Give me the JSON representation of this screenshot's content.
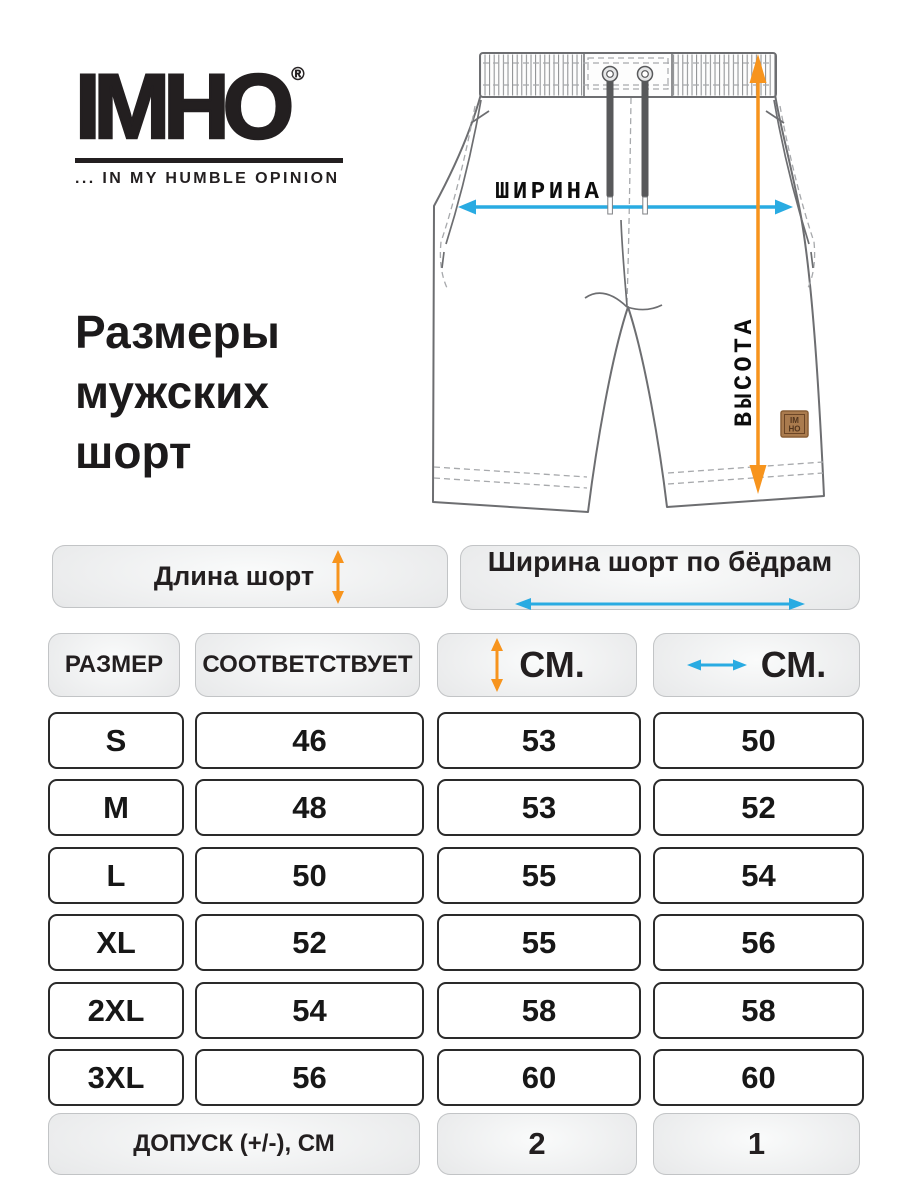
{
  "logo": {
    "text": "IMHO",
    "registered": "®",
    "tagline": "... IN MY HUMBLE OPINION"
  },
  "title": {
    "lines": [
      "Размеры",
      "мужских",
      "шорт"
    ]
  },
  "diagram": {
    "width_label": "ШИРИНА",
    "height_label": "ВЫСОТА",
    "patch_line1": "IM",
    "patch_line2": "HO"
  },
  "colors": {
    "orange": "#F7941D",
    "blue": "#29ABE2",
    "outline_gray": "#6d6e71",
    "dash_gray": "#a7a9ac",
    "ink": "#231f20"
  },
  "table": {
    "length_header": "Длина шорт",
    "width_header": "Ширина шорт по бёдрам",
    "col_size": "РАЗМЕР",
    "col_corresponds": "СООТВЕТСТВУЕТ",
    "col_cm_length": "СМ.",
    "col_cm_width": "СМ.",
    "rows": [
      {
        "size": "S",
        "corresponds": "46",
        "length_cm": "53",
        "width_cm": "50"
      },
      {
        "size": "M",
        "corresponds": "48",
        "length_cm": "53",
        "width_cm": "52"
      },
      {
        "size": "L",
        "corresponds": "50",
        "length_cm": "55",
        "width_cm": "54"
      },
      {
        "size": "XL",
        "corresponds": "52",
        "length_cm": "55",
        "width_cm": "56"
      },
      {
        "size": "2XL",
        "corresponds": "54",
        "length_cm": "58",
        "width_cm": "58"
      },
      {
        "size": "3XL",
        "corresponds": "56",
        "length_cm": "60",
        "width_cm": "60"
      }
    ],
    "tolerance_label": "ДОПУСК  (+/-), СМ",
    "tolerance_length": "2",
    "tolerance_width": "1"
  }
}
